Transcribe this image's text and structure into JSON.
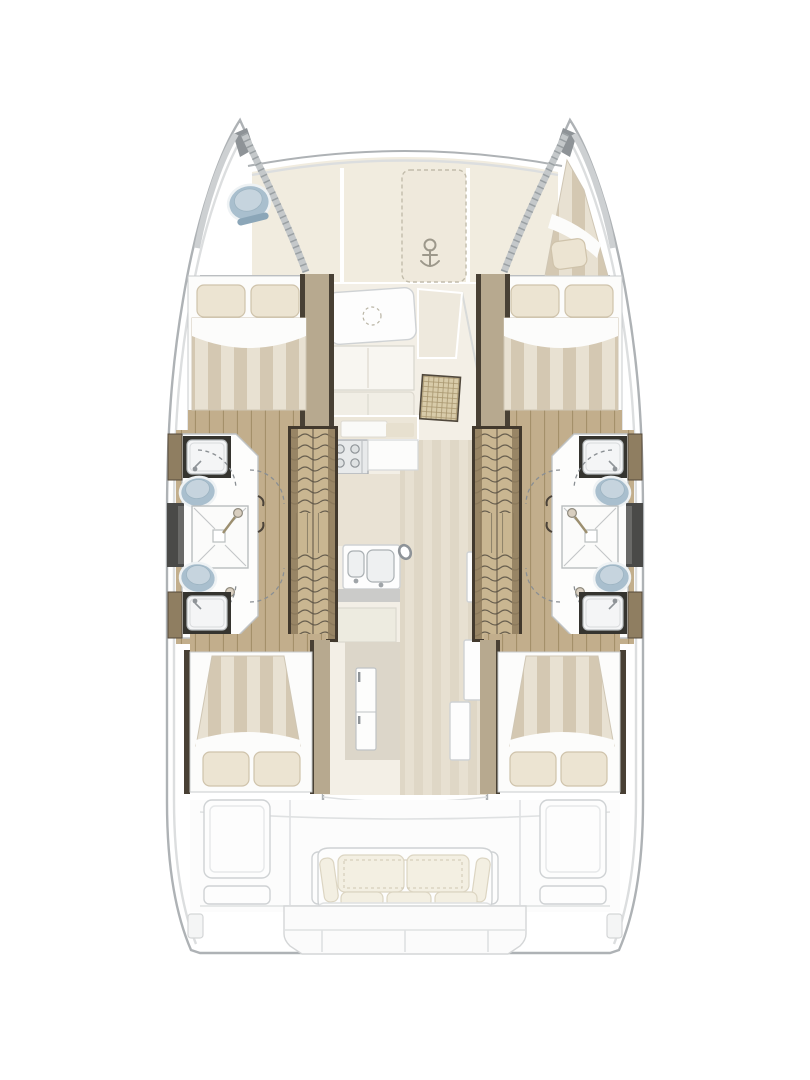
{
  "figure": {
    "type": "floor-plan",
    "subject": "catamaran-yacht-deck-plan"
  },
  "palette": {
    "page_bg": "#ffffff",
    "hull_fill": "#ffffff",
    "hull_line": "#aeb2b5",
    "hull_line_soft": "#dcdedf",
    "deck_cream": "#f1ecdf",
    "saloon_floor": "#f3efe6",
    "galley_floor": "#e9e2d4",
    "corridor_a": "#e6dfd0",
    "corridor_b": "#dcd3c1",
    "wood": "#c2ae8c",
    "wood_line": "#a08c66",
    "wood_panel": "#b7a98f",
    "trim_dark": "#484034",
    "stair_wood": "#c9b691",
    "stair_line": "#6a6150",
    "stair_rail": "#8f7d5d",
    "bed_white": "#fcfcfb",
    "pillow": "#ece4d2",
    "pillow_line": "#cfc3ab",
    "duvet_a": "#e8e1d2",
    "duvet_b": "#d4c8b2",
    "toilet_blue": "#a9bfce",
    "toilet_blue_deep": "#8ba6b8",
    "fixture_line": "#9fa4a8",
    "white_furniture": "#fdfdfd",
    "furniture_line": "#cfd2d4",
    "cushion": "#f3efe2",
    "cushion_line": "#dcd5c2",
    "rattan_bg": "#d8cba9",
    "rattan_line": "#a8966e",
    "window_dark": "#4a4a48",
    "dash_line": "#8a8f93",
    "anchor_gray": "#8f8a7d"
  },
  "areas": [
    "foredeck",
    "anchor-locker",
    "port-bow-head",
    "starboard-bow-berth",
    "port-forward-cabin",
    "starboard-forward-cabin",
    "port-bathroom",
    "starboard-bathroom",
    "port-staircase",
    "starboard-staircase",
    "saloon",
    "galley",
    "port-aft-cabin",
    "starboard-aft-cabin",
    "aft-cockpit",
    "stern-platform"
  ],
  "inventory": {
    "double_beds": 4,
    "single_bow_berths": 1,
    "pillows": 9,
    "toilets": 5,
    "bathroom_sinks": 4,
    "shower_stalls": 2,
    "shower_heads": 4,
    "staircases": 2,
    "stair_flights_per_staircase": 2,
    "saloon_tables": 1,
    "galley_burners": 4,
    "galley_sink_basins": 2,
    "refrigerators": 1,
    "sofa_back_cushions": 2,
    "sofa_seat_cushions": 3,
    "cockpit_locker_panels": 4,
    "dark_hull_windows": 2,
    "windlass": 1
  }
}
